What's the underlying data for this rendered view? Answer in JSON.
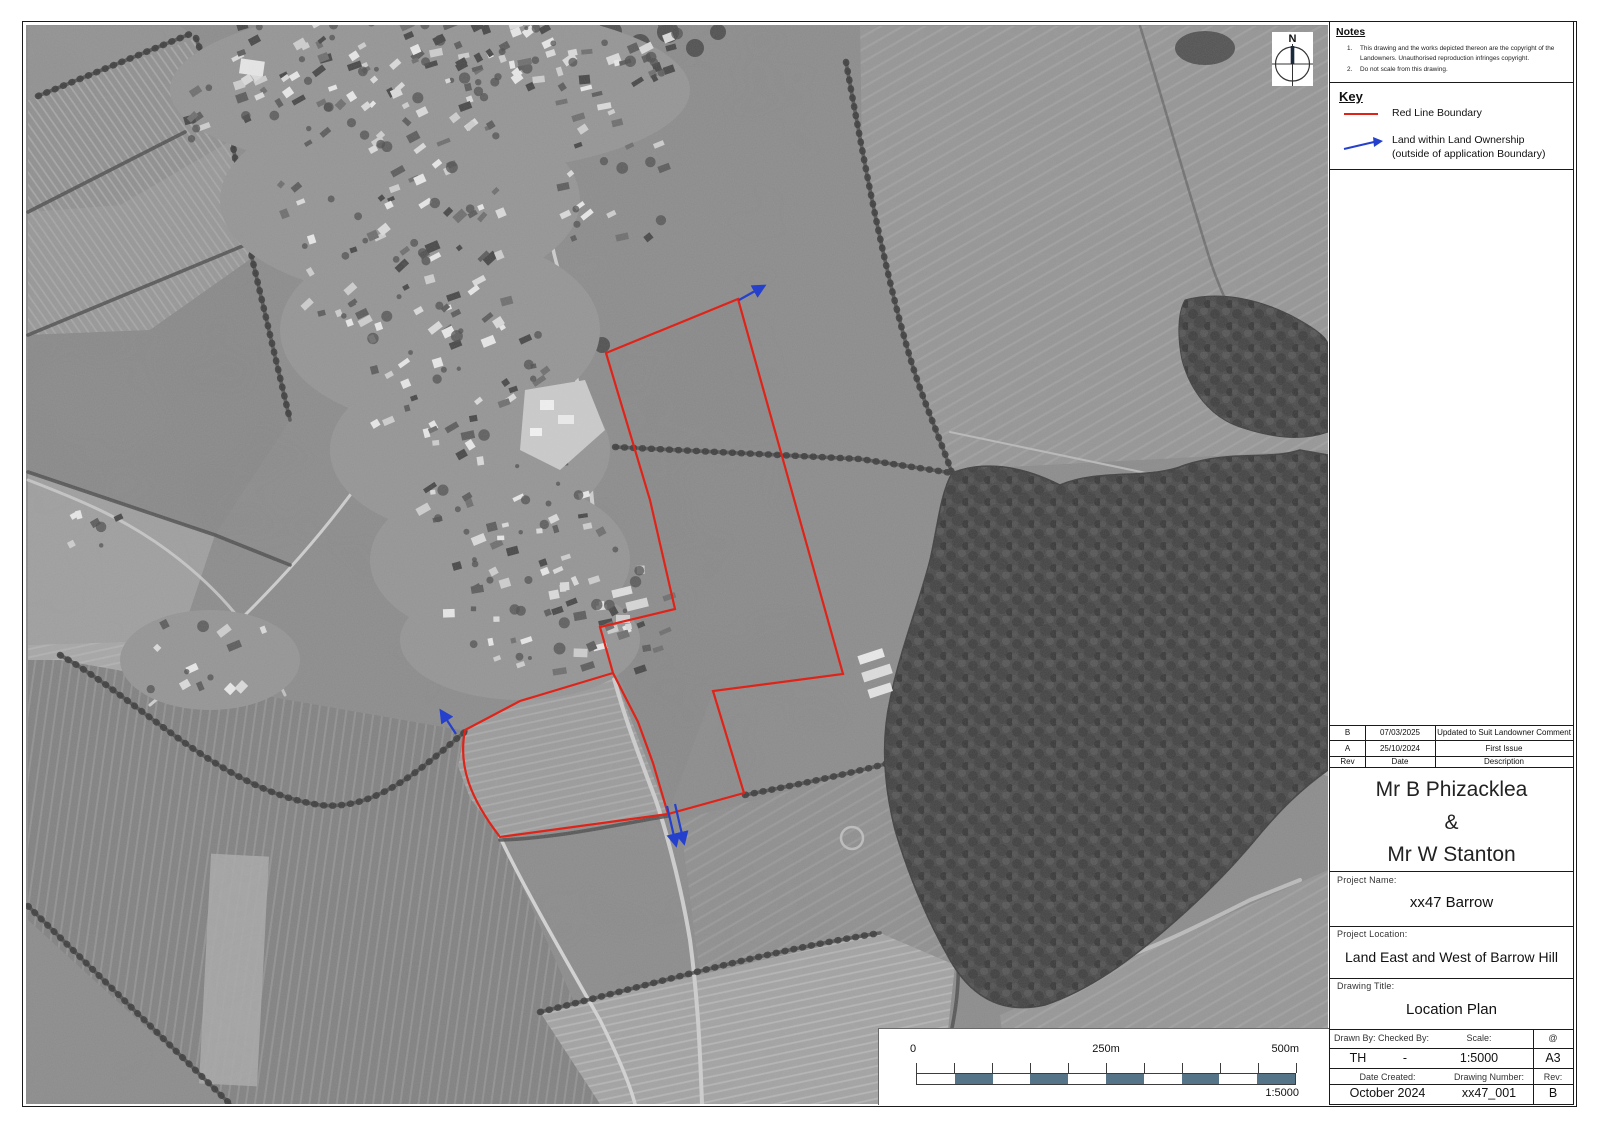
{
  "north": {
    "label": "N"
  },
  "notes": {
    "heading": "Notes",
    "items": [
      {
        "num": "1.",
        "text": "This drawing and the works depicted thereon are the copyright of the Landowners. Unauthorised reproduction infringes copyright."
      },
      {
        "num": "2.",
        "text": "Do not scale from this drawing."
      }
    ]
  },
  "key": {
    "heading": "Key",
    "red_label": "Red Line Boundary",
    "arrow_label": "Land within Land Ownership (outside of application Boundary)"
  },
  "revisions": {
    "columns": [
      "Rev",
      "Date",
      "Description"
    ],
    "rows": [
      [
        "B",
        "07/03/2025",
        "Updated to Suit Landowner Comment"
      ],
      [
        "A",
        "25/10/2024",
        "First Issue"
      ]
    ]
  },
  "client": {
    "name1": "Mr B Phizacklea",
    "joiner": "&",
    "name2": "Mr W Stanton"
  },
  "project_name": {
    "label": "Project Name:",
    "value": "xx47 Barrow"
  },
  "project_location": {
    "label": "Project Location:",
    "value": "Land East and West of Barrow Hill"
  },
  "drawing_title": {
    "label": "Drawing Title:",
    "value": "Location Plan"
  },
  "details": {
    "drawn_by_label": "Drawn By:",
    "checked_by_label": "Checked By:",
    "scale_label": "Scale:",
    "at_label": "@",
    "drawn_by": "TH",
    "checked_by": "-",
    "scale": "1:5000",
    "paper_size": "A3",
    "date_created_label": "Date Created:",
    "drawing_number_label": "Drawing Number:",
    "rev_label": "Rev:",
    "date_created": "October 2024",
    "drawing_number": "xx47_001",
    "rev": "B"
  },
  "scalebar": {
    "start": "0",
    "mid": "250m",
    "end": "500m",
    "ratio": "1:5000",
    "segments": 10,
    "segment_color": "#567488"
  },
  "map": {
    "boundary_color": "#e02318",
    "ownership_color": "#2540cc"
  }
}
